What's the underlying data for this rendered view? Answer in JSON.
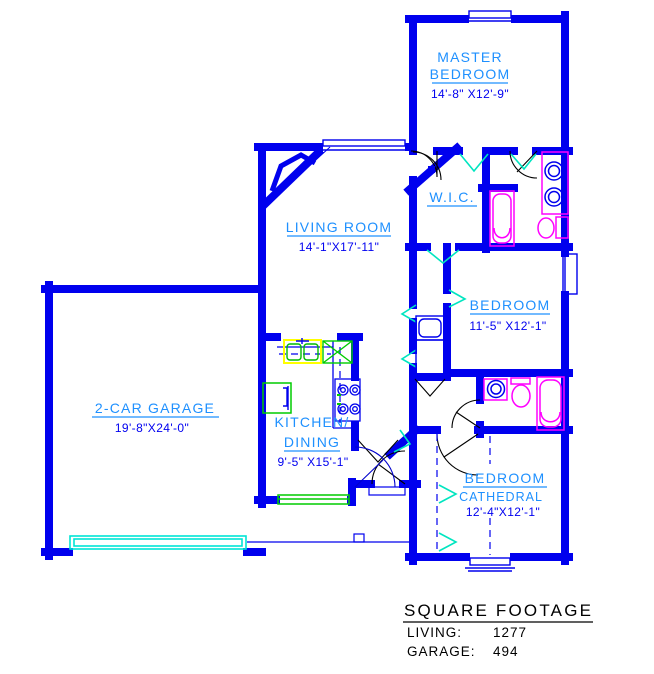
{
  "plan": {
    "rooms": {
      "master_bedroom": {
        "line1": "MASTER",
        "line2": "BEDROOM",
        "dims": "14'-8\" X12'-9\""
      },
      "wic": {
        "name": "W.I.C."
      },
      "living_room": {
        "name": "LIVING ROOM",
        "dims": "14'-1\"X17'-11\""
      },
      "bedroom_middle": {
        "name": "BEDROOM",
        "dims": "11'-5\" X12'-1\""
      },
      "kitchen_dining": {
        "line1": "KITCHEN/",
        "line2": "DINING",
        "dims": "9'-5\" X15'-1\""
      },
      "garage": {
        "name": "2-CAR GARAGE",
        "dims": "19'-8\"X24'-0\""
      },
      "bedroom_cathedral": {
        "name": "BEDROOM",
        "subtitle": "CATHEDRAL",
        "dims": "12'-4\"X12'-1\""
      }
    },
    "square_footage": {
      "title": "SQUARE FOOTAGE",
      "rows": [
        {
          "label": "LIVING:",
          "value": "1277"
        },
        {
          "label": "GARAGE:",
          "value": "494"
        }
      ]
    },
    "colors": {
      "wall": "#0000EE",
      "room_label": "#1E90FF",
      "dimension": "#0000F0",
      "door_swing_cyan": "#00E5C0",
      "fixture_magenta": "#FF00FF",
      "kitchen_green": "#00CC00",
      "sink_highlight_yellow": "#FFFF00",
      "table_text": "#000000"
    }
  }
}
